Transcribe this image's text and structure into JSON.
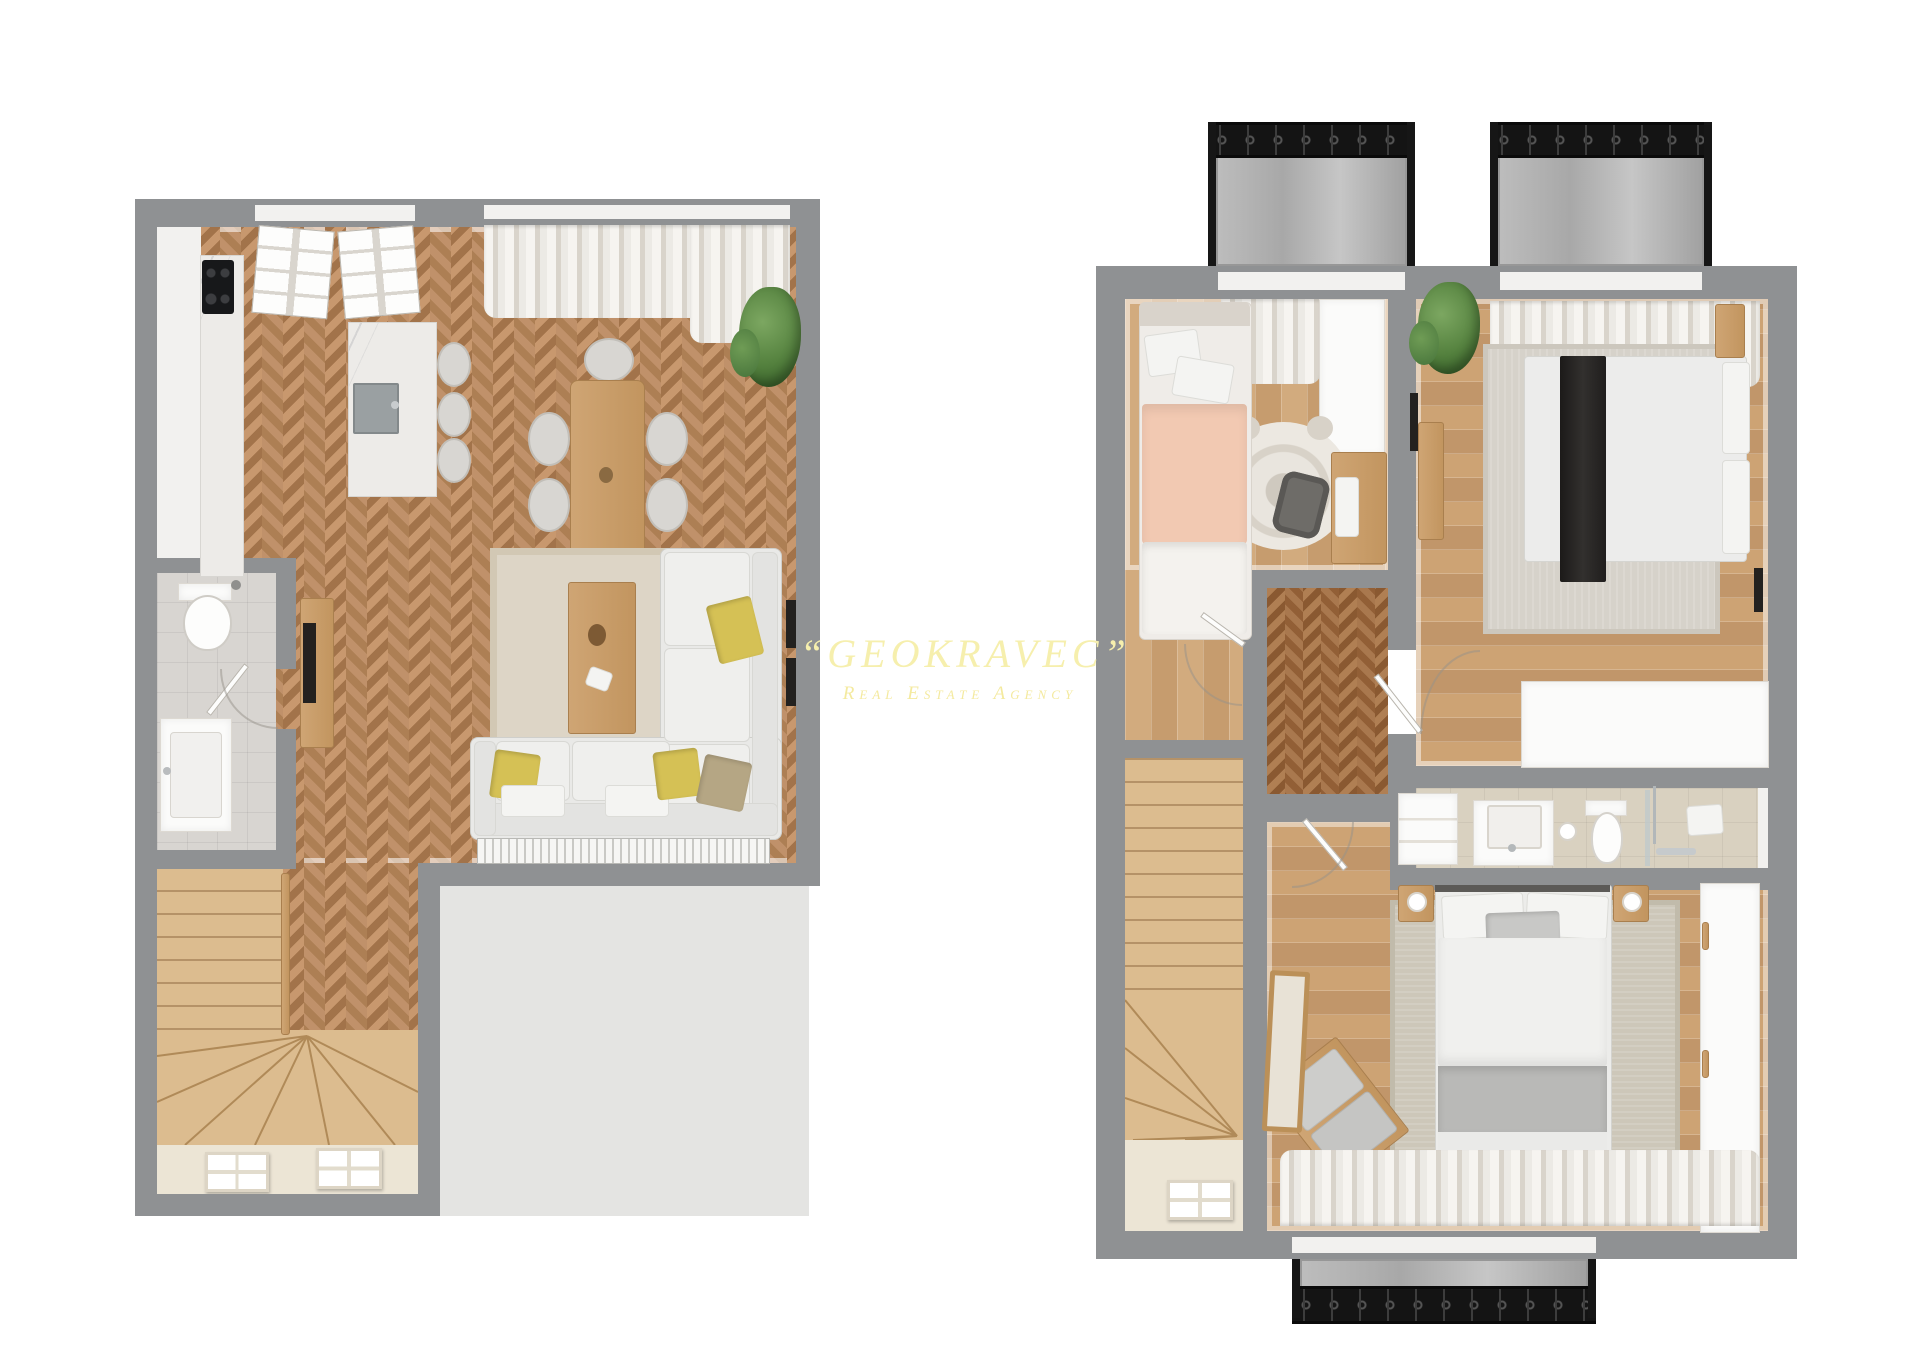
{
  "watermark": {
    "title": "“GEOKRAVEC”",
    "subtitle": "Real Estate Agency"
  },
  "palette": {
    "background": "#ffffff",
    "wall_gray": "#8f9193",
    "herringbone_wood": "#b9895c",
    "plank_wood": "#cda476",
    "stair_wood": "#dcbc8f",
    "furniture_wood": "#c9a068",
    "bathroom_tile": "#d8d5d1",
    "upper_bath_tile": "#d9d1c0",
    "terrace_slab": "#e4e4e2",
    "rug_beige": "#ddd5c6",
    "upholstery_white": "#e9e9e7",
    "accent_pillow_yellow": "#d5c155",
    "kids_bed_pink": "#f2c9b2",
    "throw_black": "#232120",
    "balcony_railing": "#141414",
    "watermark_yellow": "#f6efad"
  }
}
